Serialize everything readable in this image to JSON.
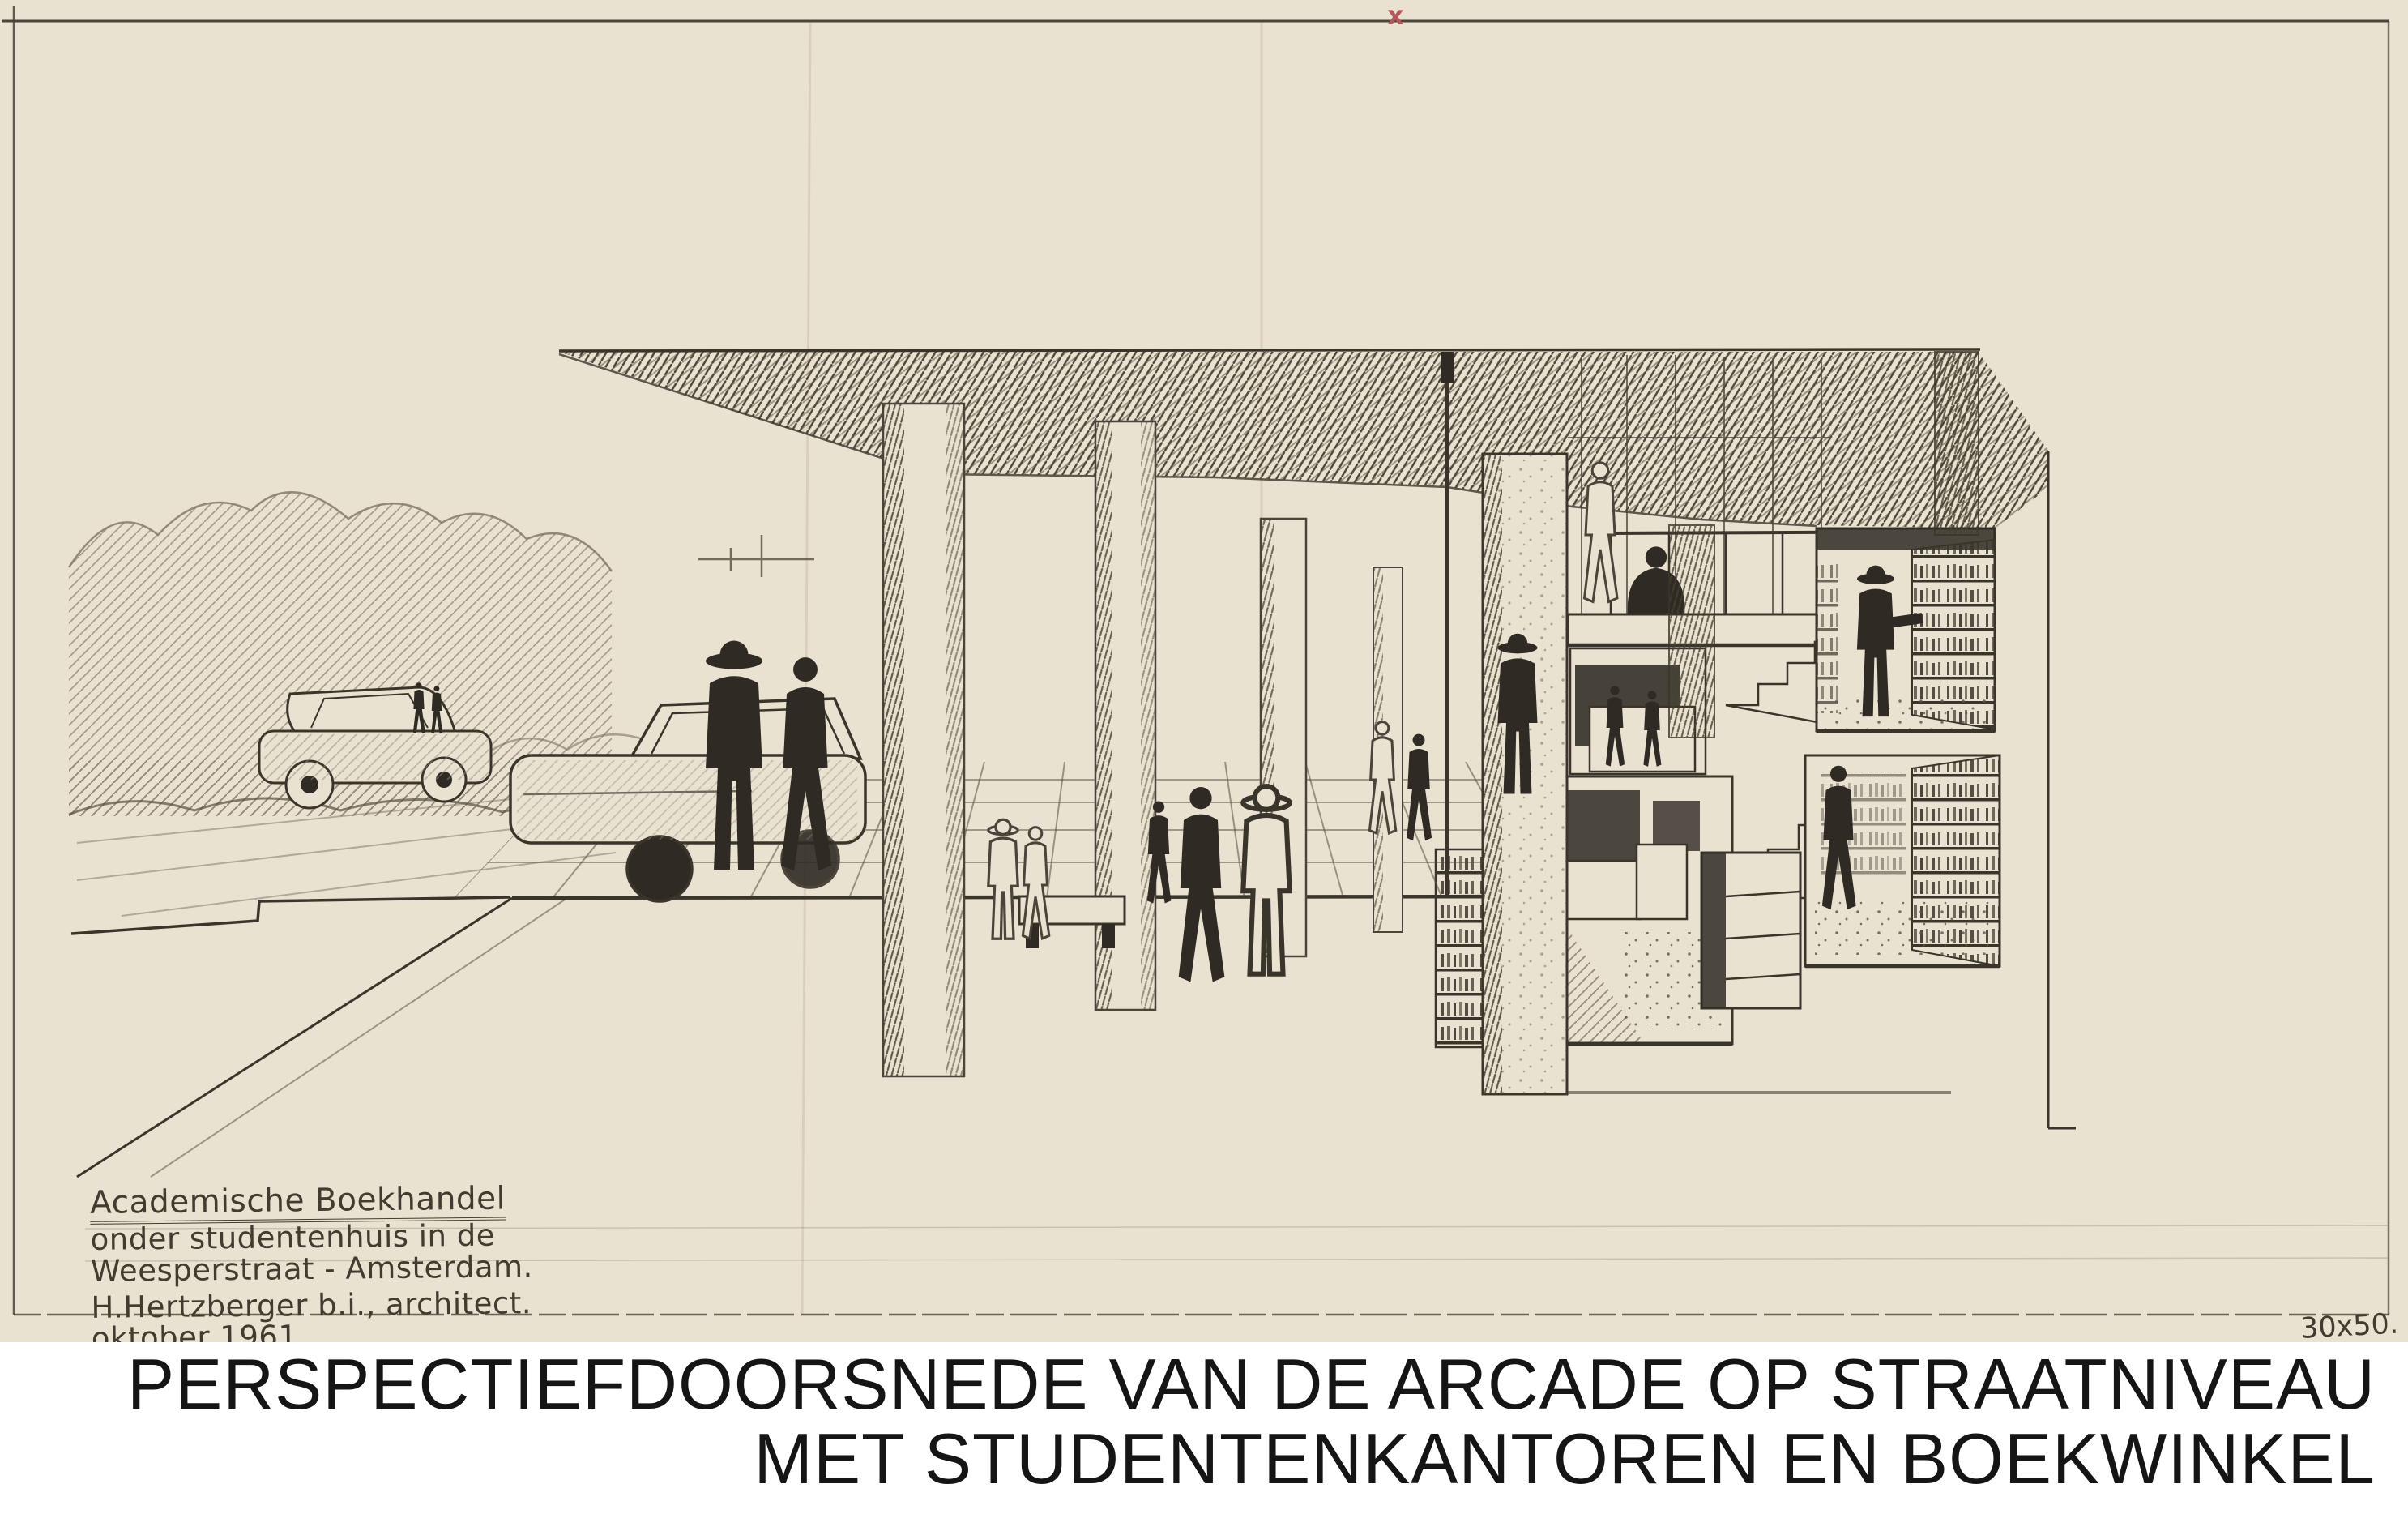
{
  "sheet": {
    "title_block": {
      "line1": "Academische Boekhandel",
      "line2": "onder studentenhuis in de",
      "line3": "Weesperstraat - Amsterdam.",
      "line4": "H.Hertzberger b.i., architect.",
      "line5": "oktober 1961"
    },
    "format_note": "30x50.",
    "registration_mark": "x"
  },
  "caption": {
    "line1": "PERSPECTIEFDOORSNEDE VAN DE ARCADE OP STRAATNIVEAU",
    "line2": "MET STUDENTENKANTOREN EN BOEKWINKEL"
  },
  "colors": {
    "paper": "#e9e2d0",
    "ink": "#3a352b",
    "hatch": "#4e4739",
    "light_hatch": "#8f8773",
    "caption_bg": "#ffffff",
    "caption_text": "#151515",
    "registration_mark": "#b5565c",
    "fold_line": "#d8cfba"
  }
}
